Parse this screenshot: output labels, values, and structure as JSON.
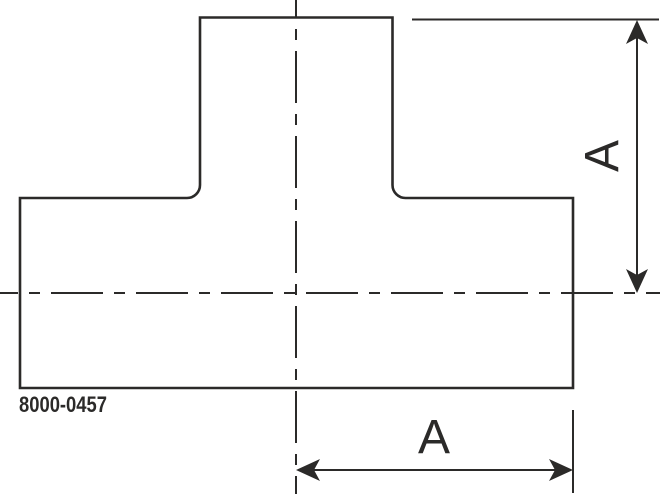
{
  "drawing": {
    "type": "technical-drawing-tee-fitting",
    "part_number": "8000-0457",
    "dimensions": {
      "vertical_label": "A",
      "horizontal_label": "A"
    },
    "colors": {
      "line": "#2b2a29",
      "background": "#ffffff"
    }
  }
}
